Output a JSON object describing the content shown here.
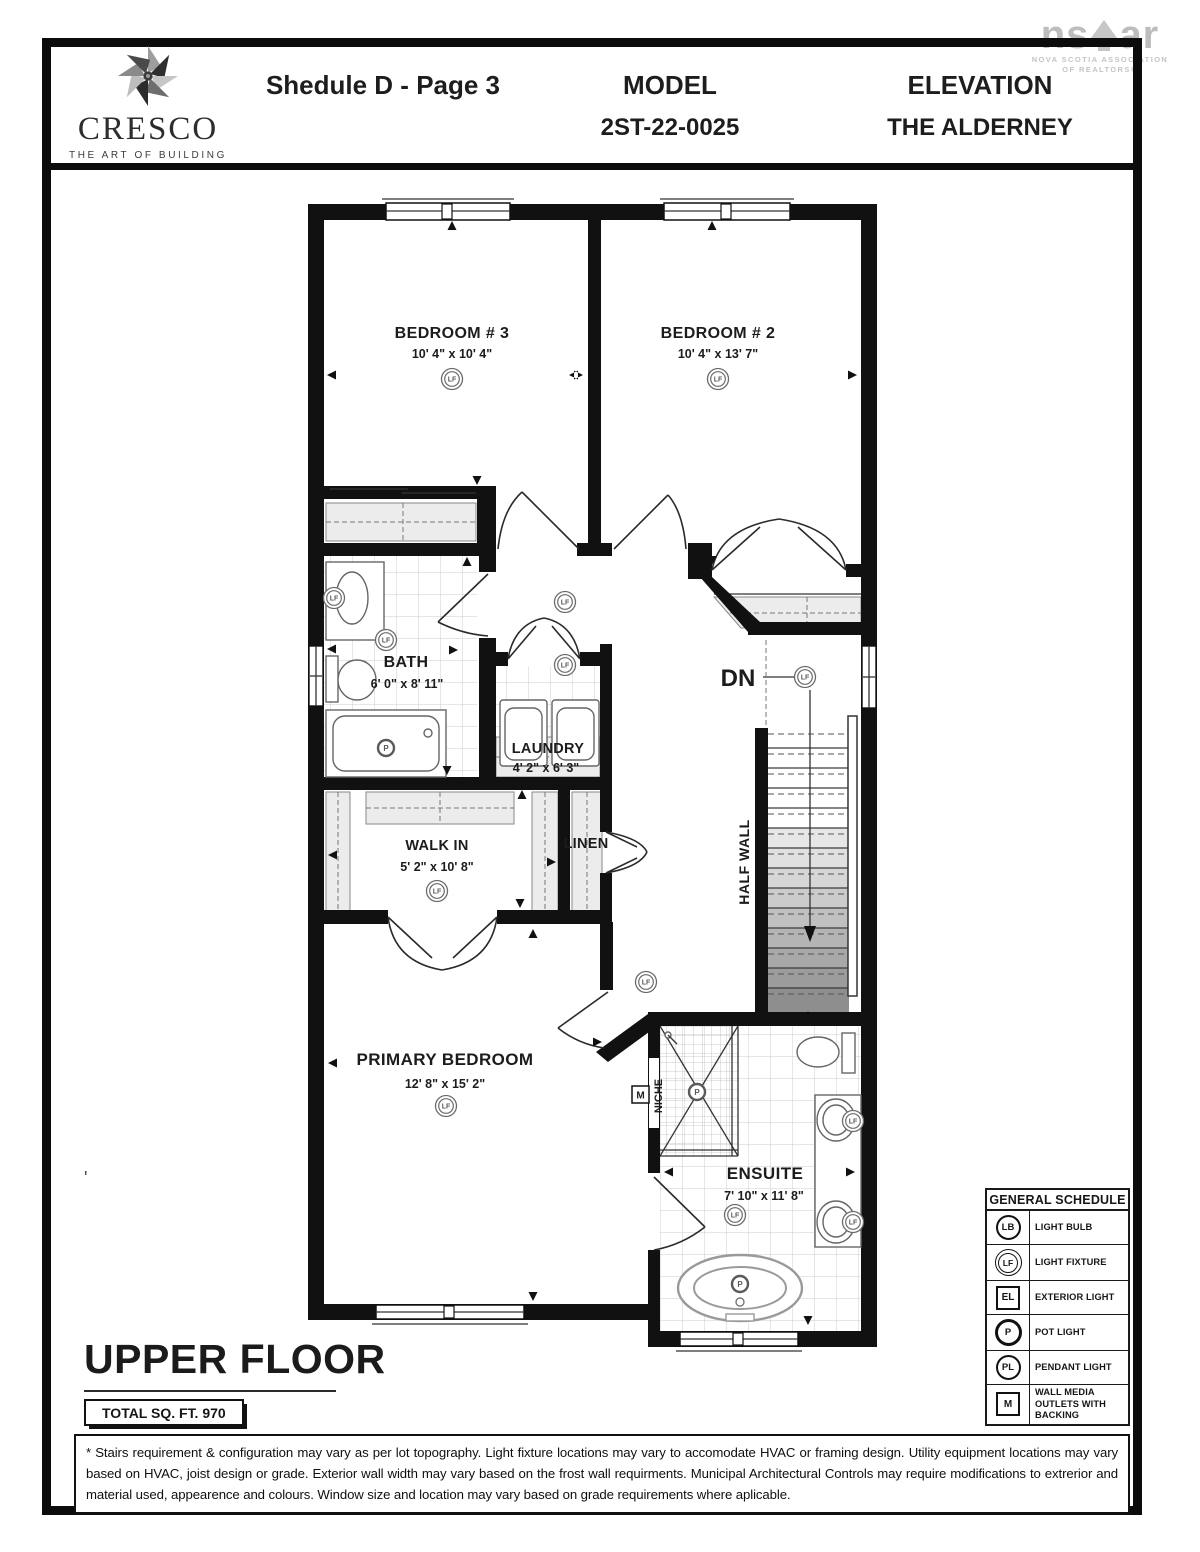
{
  "header": {
    "brand": {
      "name": "CRESCO",
      "tagline": "THE ART OF BUILDING"
    },
    "schedule_title": "Shedule D - Page 3",
    "model_label": "MODEL",
    "model_value": "2ST-22-0025",
    "elevation_label": "ELEVATION",
    "elevation_value": "THE ALDERNEY",
    "nsar": {
      "left": "ns",
      "right": "ar",
      "line1": "NOVA SCOTIA ASSOCIATION",
      "line2": "OF REALTORS®"
    }
  },
  "plan": {
    "rooms": {
      "bedroom3": {
        "name": "BEDROOM # 3",
        "dims": "10' 4\" x 10' 4\""
      },
      "bedroom2": {
        "name": "BEDROOM # 2",
        "dims": "10' 4\" x 13' 7\""
      },
      "bath": {
        "name": "BATH",
        "dims": "6' 0\" x 8' 11\""
      },
      "laundry": {
        "name": "LAUNDRY",
        "dims": "4' 2\" x 6' 3\""
      },
      "walkin": {
        "name": "WALK IN",
        "dims": "5' 2\" x 10' 8\""
      },
      "linen": {
        "name": "LINEN"
      },
      "primary": {
        "name": "PRIMARY BEDROOM",
        "dims": "12' 8\" x 15' 2\""
      },
      "ensuite": {
        "name": "ENSUITE",
        "dims": "7' 10\" x 11' 8\""
      }
    },
    "annotations": {
      "down": "DN",
      "half_wall": "HALF WALL",
      "niche": "NICHE"
    },
    "symbols": {
      "lf": "LF",
      "p": "P",
      "m": "M"
    }
  },
  "legend": {
    "title": "GENERAL SCHEDULE",
    "rows": [
      {
        "code": "LB",
        "label": "LIGHT BULB"
      },
      {
        "code": "LF",
        "label": "LIGHT FIXTURE"
      },
      {
        "code": "EL",
        "label": "EXTERIOR LIGHT"
      },
      {
        "code": "P",
        "label": "POT LIGHT"
      },
      {
        "code": "PL",
        "label": "PENDANT LIGHT"
      },
      {
        "code": "M",
        "label": "WALL MEDIA OUTLETS WITH BACKING"
      }
    ]
  },
  "footer": {
    "floor_title": "UPPER FLOOR",
    "total_sqft": "TOTAL SQ. FT. 970",
    "disclaimer": "* Stairs requirement & configuration may vary as per lot topography. Light fixture locations may vary to accomodate HVAC or framing design. Utility equipment locations may vary based on HVAC, joist design or grade. Exterior wall width may vary based on the frost wall requirments. Municipal Architectural Controls may require modifications to extrerior and material used, appearence and colours. Window size and location may vary based on grade requirements where aplicable."
  },
  "misc": {
    "stray_mark": "'"
  },
  "colors": {
    "wall": "#111111",
    "shelf": "#ececec",
    "tile_line": "#c9c9c9",
    "logo_gray": "#bdbdbd",
    "stair_dark": "#8e8e8e"
  }
}
